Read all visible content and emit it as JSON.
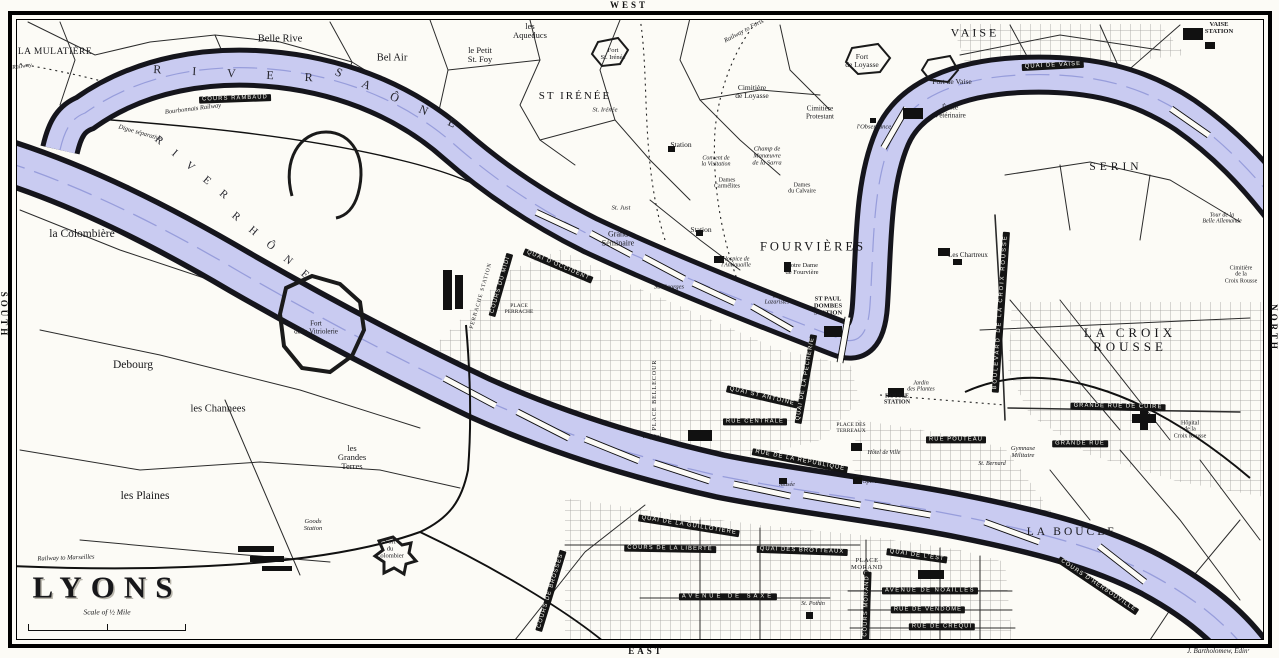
{
  "title": {
    "text": "LYONS",
    "scale_caption": "Scale of ½ Mile",
    "attribution": "J. Bartholomew, Edinʳ"
  },
  "compass": {
    "top": "WEST",
    "bottom": "EAST",
    "left": "SOUTH",
    "right": "NORTH"
  },
  "colors": {
    "water": "#c9cbf1",
    "ink": "#141414",
    "paper": "#fcfbf6"
  },
  "labels": [
    {
      "t": "Railway",
      "x": 22,
      "y": 67,
      "s": 6,
      "c": "it",
      "r": -8
    },
    {
      "t": "LA MULATIÈRE",
      "x": 55,
      "y": 52,
      "s": 9.5,
      "ls": 0.5
    },
    {
      "t": "Belle Rive",
      "x": 280,
      "y": 39,
      "s": 10.5
    },
    {
      "t": "Bel Air",
      "x": 392,
      "y": 58,
      "s": 10.5
    },
    {
      "t": "le Petit\nSt. Foy",
      "x": 480,
      "y": 55,
      "s": 8.5
    },
    {
      "t": "les\nAqueducs",
      "x": 530,
      "y": 31,
      "s": 8.5
    },
    {
      "t": "Fort\nSt. Irénée",
      "x": 613,
      "y": 54,
      "s": 6.5
    },
    {
      "t": "ST IRÉNÉE",
      "x": 575,
      "y": 97,
      "s": 11,
      "ls": 2
    },
    {
      "t": "St. Irénée",
      "x": 605,
      "y": 110,
      "s": 6.5,
      "c": "it"
    },
    {
      "t": "Railway to Forts",
      "x": 744,
      "y": 31,
      "s": 6.5,
      "c": "it",
      "r": -28
    },
    {
      "t": "Cimitière\nde Loyasse",
      "x": 752,
      "y": 92,
      "s": 7.5
    },
    {
      "t": "Fort\nde Loyasse",
      "x": 862,
      "y": 61,
      "s": 7.5
    },
    {
      "t": "Cimitière\nProtestant",
      "x": 820,
      "y": 113,
      "s": 7
    },
    {
      "t": "l'Observance",
      "x": 874,
      "y": 127,
      "s": 6.5,
      "c": "it"
    },
    {
      "t": "VAISE",
      "x": 975,
      "y": 33,
      "s": 12,
      "ls": 3
    },
    {
      "t": "VAISE\nSTATION",
      "x": 1219,
      "y": 28,
      "s": 6.5,
      "c": "bold"
    },
    {
      "t": "Fort de Vaise",
      "x": 952,
      "y": 82,
      "s": 7.5
    },
    {
      "t": "École\nVétérinaire",
      "x": 950,
      "y": 112,
      "s": 7
    },
    {
      "t": "QUAI DE VAISE",
      "x": 1053,
      "y": 66,
      "c": "rib",
      "r": -3
    },
    {
      "t": "COURS RAMBAUD",
      "x": 235,
      "y": 99,
      "c": "rib",
      "r": -2
    },
    {
      "t": "Bourbonnais Railway",
      "x": 193,
      "y": 109,
      "s": 6.5,
      "c": "it",
      "r": -7
    },
    {
      "t": "Digue séparative",
      "x": 140,
      "y": 133,
      "s": 6.5,
      "c": "it",
      "r": 16
    },
    {
      "t": "R I V E R",
      "x": 240,
      "y": 74,
      "s": 12,
      "ls": 14,
      "c": "riv",
      "r": 3
    },
    {
      "t": "S A Ô N E",
      "x": 400,
      "y": 100,
      "s": 12,
      "ls": 10,
      "c": "riv",
      "r": 24
    },
    {
      "t": "R I V E R",
      "x": 193,
      "y": 170,
      "s": 11,
      "ls": 6,
      "c": "riv",
      "r": 40
    },
    {
      "t": "R H Ô N E",
      "x": 272,
      "y": 248,
      "s": 11,
      "ls": 6,
      "c": "riv",
      "r": 40
    },
    {
      "t": "SERIN",
      "x": 1116,
      "y": 167,
      "s": 11.5,
      "ls": 4
    },
    {
      "t": "Tour de la\nBelle Allemande",
      "x": 1222,
      "y": 219,
      "s": 6,
      "c": "it"
    },
    {
      "t": "Cimitière\nde la\nCroix Rousse",
      "x": 1241,
      "y": 275,
      "s": 6
    },
    {
      "t": "Station",
      "x": 681,
      "y": 145,
      "s": 7.5
    },
    {
      "t": "Convent de\nla Visitation",
      "x": 716,
      "y": 162,
      "s": 6,
      "c": "it"
    },
    {
      "t": "Champ de\nManœuvre\nde la Sarra",
      "x": 767,
      "y": 156,
      "s": 6.5,
      "c": "it"
    },
    {
      "t": "Dames\nCarmélites",
      "x": 727,
      "y": 184,
      "s": 6
    },
    {
      "t": "Dames\ndu Calvaire",
      "x": 802,
      "y": 189,
      "s": 6
    },
    {
      "t": "St. Just",
      "x": 621,
      "y": 208,
      "s": 6.5,
      "c": "it"
    },
    {
      "t": "Grand\nSéminaire",
      "x": 618,
      "y": 239,
      "s": 8
    },
    {
      "t": "Station",
      "x": 701,
      "y": 230,
      "s": 7.5
    },
    {
      "t": "FOURVIÈRES",
      "x": 813,
      "y": 247,
      "s": 12.5,
      "ls": 3
    },
    {
      "t": "Notre Dame\nde Fourvière",
      "x": 802,
      "y": 269,
      "s": 6.5
    },
    {
      "t": "Hospice de\nl'Antiquaille",
      "x": 736,
      "y": 263,
      "s": 6,
      "c": "it"
    },
    {
      "t": "Les\nLazaristes",
      "x": 777,
      "y": 300,
      "s": 6,
      "c": "it"
    },
    {
      "t": "St. Georges",
      "x": 669,
      "y": 287,
      "s": 6.5,
      "c": "it"
    },
    {
      "t": "ST PAUL\nDOMBES\nSTATION",
      "x": 828,
      "y": 306,
      "s": 6.5,
      "c": "bold"
    },
    {
      "t": "Les Chartreux",
      "x": 968,
      "y": 256,
      "s": 7
    },
    {
      "t": "la Colombière",
      "x": 82,
      "y": 234,
      "s": 11.5
    },
    {
      "t": "Fort\nde la Vitriolerie",
      "x": 316,
      "y": 328,
      "s": 7
    },
    {
      "t": "Debourg",
      "x": 133,
      "y": 365,
      "s": 11.5
    },
    {
      "t": "les Channees",
      "x": 218,
      "y": 409,
      "s": 10.5
    },
    {
      "t": "les\nGrandes\nTerres",
      "x": 352,
      "y": 458,
      "s": 8.5
    },
    {
      "t": "les Plaines",
      "x": 145,
      "y": 496,
      "s": 11.5
    },
    {
      "t": "Goods\nStation",
      "x": 313,
      "y": 525,
      "s": 6.5,
      "c": "it"
    },
    {
      "t": "Fort\ndu\nColombier",
      "x": 390,
      "y": 549,
      "s": 6.5
    },
    {
      "t": "Railway to Marseilles",
      "x": 66,
      "y": 558,
      "s": 6.5,
      "c": "it",
      "r": -2
    },
    {
      "t": "BOULEVARD DE LA CROIX ROUSSE",
      "x": 1001,
      "y": 312,
      "c": "rib",
      "r": -86,
      "ls": 2
    },
    {
      "t": "LA CROIX ROUSSE",
      "x": 1130,
      "y": 340,
      "s": 13,
      "ls": 4
    },
    {
      "t": "GRANDE RUE DE CUIRE",
      "x": 1118,
      "y": 407,
      "c": "rib",
      "r": 1
    },
    {
      "t": "GRANDE RUE",
      "x": 1080,
      "y": 444,
      "c": "rib"
    },
    {
      "t": "RUE POUTEAU",
      "x": 956,
      "y": 440,
      "c": "rib"
    },
    {
      "t": "ROUSSE\nSTATION",
      "x": 897,
      "y": 400,
      "s": 6,
      "c": "bold"
    },
    {
      "t": "Jardin\ndes Plantes",
      "x": 921,
      "y": 387,
      "s": 6,
      "c": "it"
    },
    {
      "t": "Gymnase\nMilitaire",
      "x": 1023,
      "y": 452,
      "s": 6.5,
      "c": "it"
    },
    {
      "t": "St. Bernard",
      "x": 992,
      "y": 464,
      "s": 6,
      "c": "it"
    },
    {
      "t": "Hôpital\nde la\nCroix Rousse",
      "x": 1190,
      "y": 430,
      "s": 6
    },
    {
      "t": "QUAI ST ANTOINE",
      "x": 762,
      "y": 397,
      "c": "rib",
      "r": 13
    },
    {
      "t": "RUE CENTRALE",
      "x": 755,
      "y": 422,
      "c": "rib"
    },
    {
      "t": "QUAI DE LA PÊCHERIE",
      "x": 806,
      "y": 379,
      "c": "rib",
      "r": -80
    },
    {
      "t": "RUE DE LA RÉPUBLIQUE",
      "x": 800,
      "y": 461,
      "c": "rib",
      "r": 11
    },
    {
      "t": "PLACE DES\nTERREAUX",
      "x": 851,
      "y": 429,
      "s": 5.5
    },
    {
      "t": "Hôtel de Ville",
      "x": 884,
      "y": 453,
      "s": 6,
      "c": "it"
    },
    {
      "t": "Musée",
      "x": 787,
      "y": 485,
      "s": 6,
      "c": "it"
    },
    {
      "t": "Opéra",
      "x": 870,
      "y": 482,
      "s": 6,
      "c": "it"
    },
    {
      "t": "Hôpital",
      "x": 652,
      "y": 437,
      "s": 6,
      "c": "it"
    },
    {
      "t": "PLACE BELLECOUR",
      "x": 655,
      "y": 395,
      "s": 6,
      "r": -90,
      "ls": 1
    },
    {
      "t": "PERRACHE STATION",
      "x": 482,
      "y": 296,
      "s": 5.5,
      "r": -74,
      "ls": 1
    },
    {
      "t": "COURS DU MIDI",
      "x": 501,
      "y": 285,
      "c": "rib",
      "r": -74
    },
    {
      "t": "PLACE\nPERRACHE",
      "x": 519,
      "y": 310,
      "s": 5.5
    },
    {
      "t": "QUAI D'OCCIDENT",
      "x": 558,
      "y": 266,
      "c": "rib",
      "r": 23
    },
    {
      "t": "QUAI DE LA GUILLOTIÈRE",
      "x": 689,
      "y": 526,
      "c": "rib",
      "r": 9
    },
    {
      "t": "COURS DE LA LIBERTÉ",
      "x": 670,
      "y": 549,
      "c": "rib",
      "r": 1
    },
    {
      "t": "COURS DE BROSSES",
      "x": 551,
      "y": 591,
      "c": "rib",
      "r": -73
    },
    {
      "t": "AVENUE DE SAXE",
      "x": 728,
      "y": 597,
      "c": "rib",
      "ls": 3
    },
    {
      "t": "QUAI DES BROTTEAUX",
      "x": 802,
      "y": 551,
      "c": "rib",
      "r": 2
    },
    {
      "t": "QUAI DE L'EST",
      "x": 917,
      "y": 556,
      "c": "rib",
      "r": 8
    },
    {
      "t": "PLACE\nMORAND",
      "x": 867,
      "y": 564,
      "s": 6.5,
      "ls": 0.5
    },
    {
      "t": "COURS MORAND",
      "x": 867,
      "y": 606,
      "c": "rib",
      "r": -88
    },
    {
      "t": "AVENUE DE NOAILLES",
      "x": 930,
      "y": 591,
      "c": "rib",
      "ls": 1.5
    },
    {
      "t": "RUE DE VENDÔME",
      "x": 928,
      "y": 610,
      "c": "rib"
    },
    {
      "t": "RUE DE CRÉQUI",
      "x": 942,
      "y": 627,
      "c": "rib"
    },
    {
      "t": "St. Pothin",
      "x": 813,
      "y": 604,
      "s": 6,
      "c": "it"
    },
    {
      "t": "LA BOUCLE",
      "x": 1072,
      "y": 532,
      "s": 11.5,
      "ls": 3
    },
    {
      "t": "COURS D'HERBOUVILLE",
      "x": 1098,
      "y": 586,
      "c": "rib",
      "r": 34
    }
  ]
}
